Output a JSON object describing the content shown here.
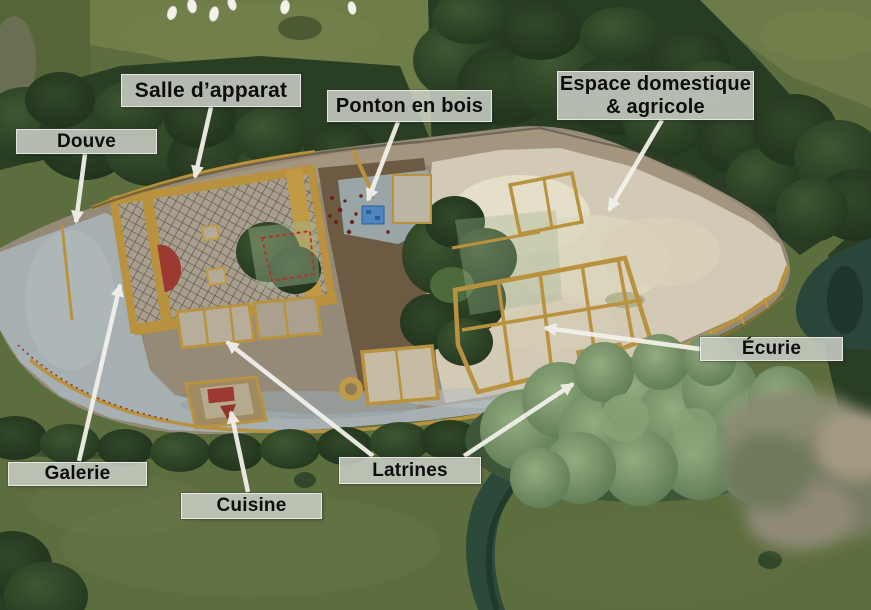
{
  "figure": {
    "description": "Annotated aerial photograph of an archaeological excavation site beside a river, with French labels and white arrows pointing to excavated medieval features.",
    "language": "fr"
  },
  "annotations": [
    {
      "id": "douve",
      "label": "Douve"
    },
    {
      "id": "salle-apparat",
      "label": "Salle d’apparat"
    },
    {
      "id": "ponton-en-bois",
      "label": "Ponton en bois"
    },
    {
      "id": "espace-domestique-agricole",
      "label": "Espace domestique\n& agricole"
    },
    {
      "id": "ecurie",
      "label": "Écurie"
    },
    {
      "id": "galerie",
      "label": "Galerie"
    },
    {
      "id": "cuisine",
      "label": "Cuisine"
    },
    {
      "id": "latrines",
      "label": "Latrines"
    }
  ],
  "style": {
    "label_background": "#cbcfc6",
    "label_text_color": "#0d0d0d",
    "arrow_color": "#f1f0ea",
    "wall_gold": "#b8923f",
    "courtyard_gray": "#a6b0b2",
    "excavation_pale": "#d2cab4",
    "river_green": "#2c4a3a",
    "grass_green": "#5d6e3e",
    "roof_red": "#9c3a31",
    "pontoon_blue": "#4f86c2"
  }
}
